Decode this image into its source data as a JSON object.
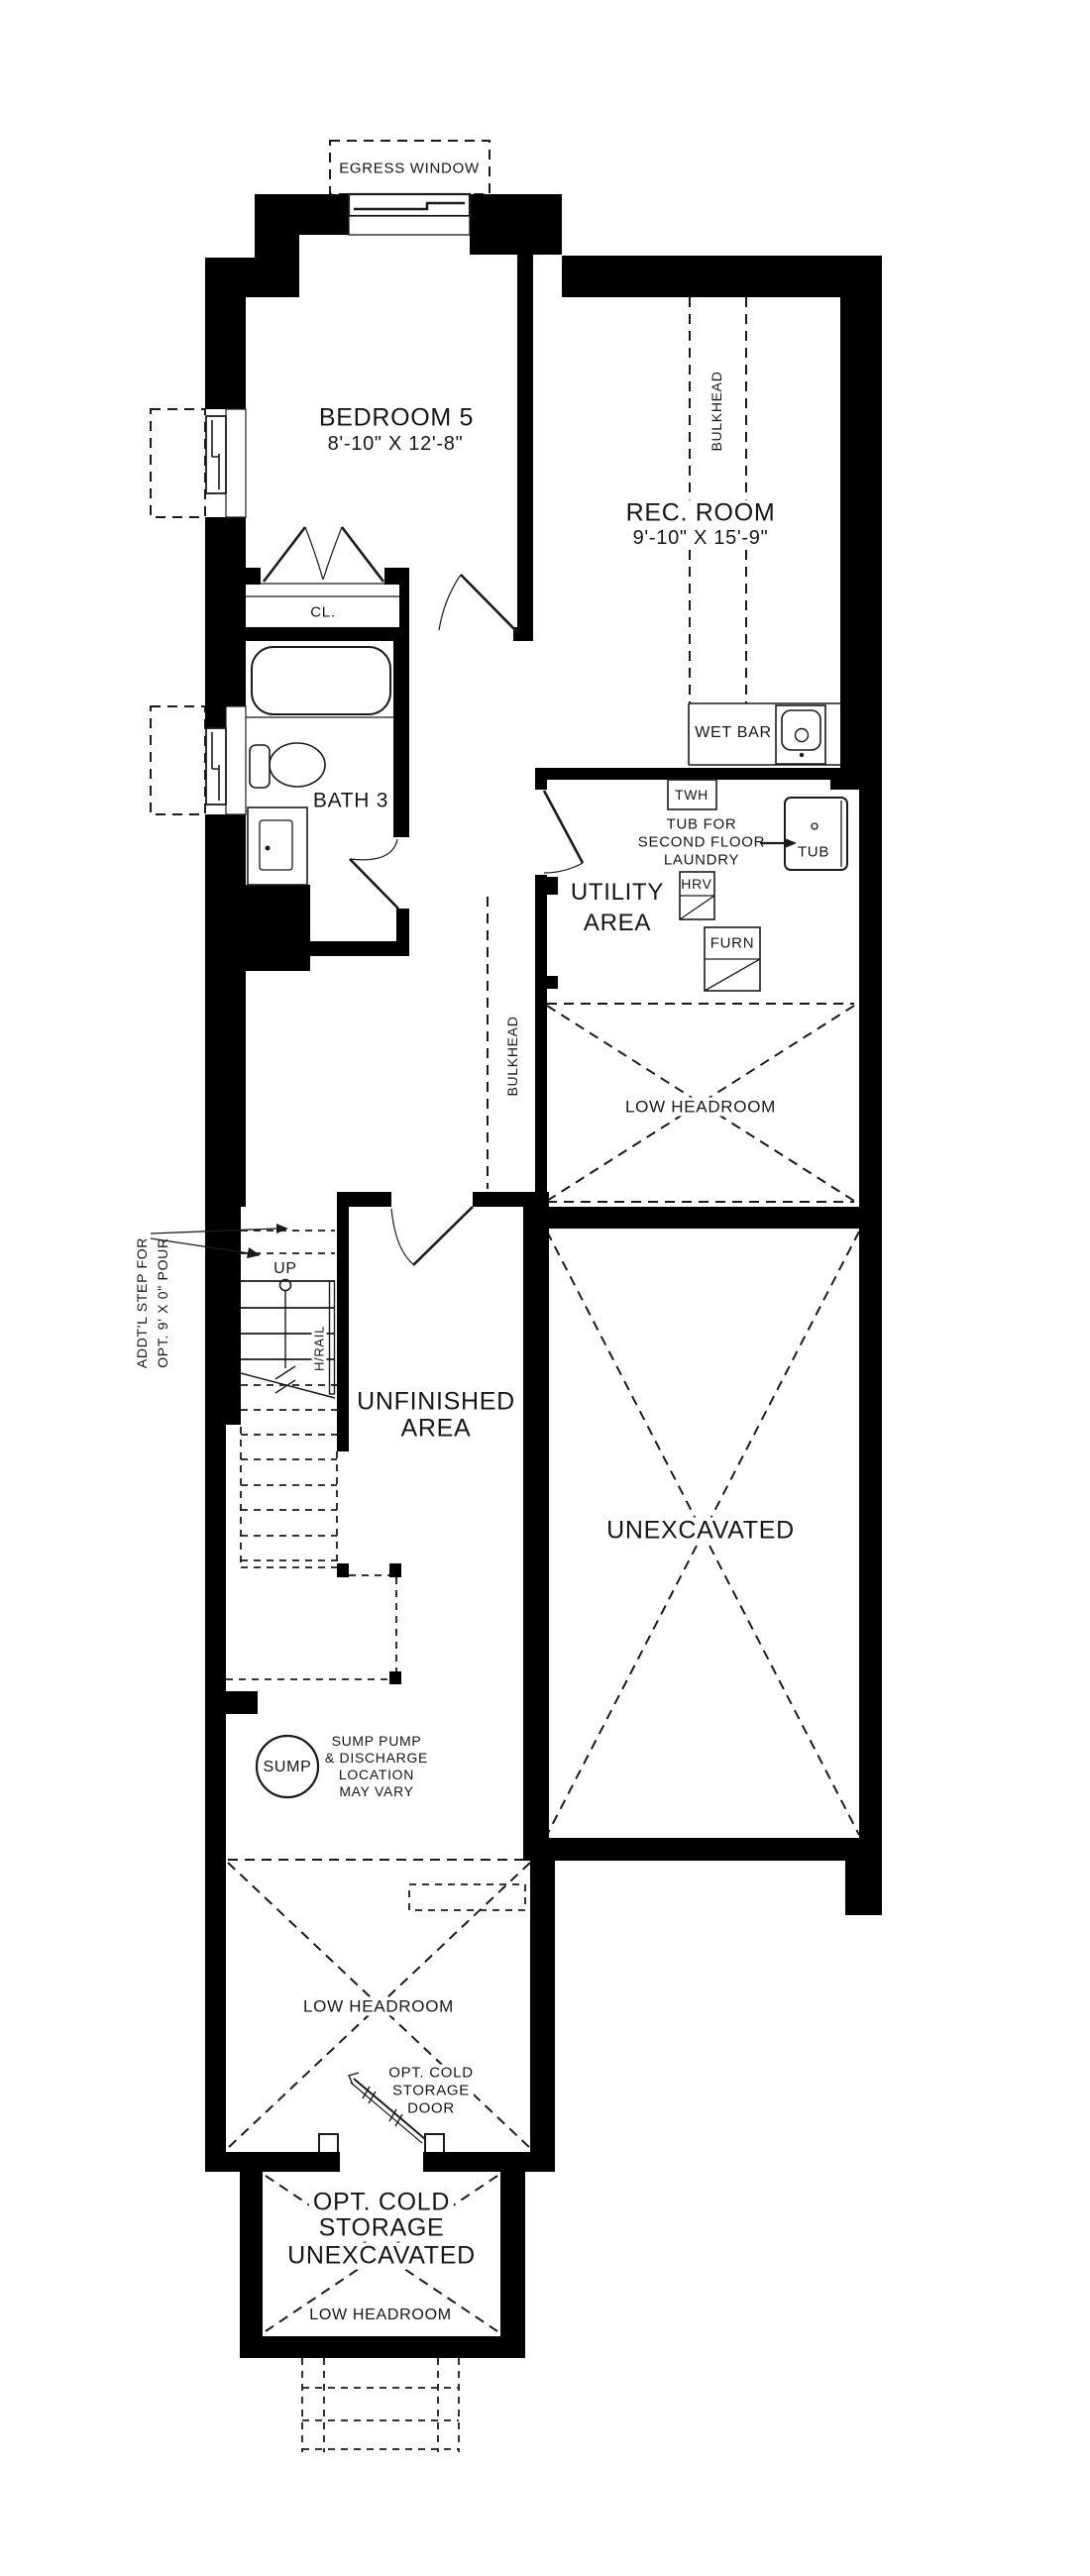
{
  "plan": {
    "egress_window": "EGRESS WINDOW",
    "bedroom": {
      "name": "BEDROOM 5",
      "dims": "8'-10\" X 12'-8\""
    },
    "rec_room": {
      "name": "REC. ROOM",
      "dims": "9'-10\" X 15'-9\""
    },
    "closet": "CL.",
    "bath": "BATH 3",
    "wet_bar": "WET BAR",
    "twh": "TWH",
    "tub": "TUB",
    "tub_note": {
      "l1": "TUB FOR",
      "l2": "SECOND FLOOR",
      "l3": "LAUNDRY"
    },
    "utility": {
      "l1": "UTILITY",
      "l2": "AREA"
    },
    "hrv": "HRV",
    "furn": "FURN",
    "bulkhead": "BULKHEAD",
    "low_headroom": "LOW HEADROOM",
    "up": "UP",
    "hrail": "H/RAIL",
    "addtl_step": {
      "l1": "ADDT'L STEP FOR",
      "l2": "OPT. 9' X 0\" POUR"
    },
    "unfinished": {
      "l1": "UNFINISHED",
      "l2": "AREA"
    },
    "unexcavated": "UNEXCAVATED",
    "sump": "SUMP",
    "sump_note": {
      "l1": "SUMP PUMP",
      "l2": "& DISCHARGE",
      "l3": "LOCATION",
      "l4": "MAY VARY"
    },
    "cold_door": {
      "l1": "OPT. COLD",
      "l2": "STORAGE",
      "l3": "DOOR"
    },
    "cold_storage": {
      "l1": "OPT. COLD",
      "l2": "STORAGE",
      "l3": "UNEXCAVATED",
      "l4": "LOW HEADROOM"
    }
  },
  "colors": {
    "wall": "#000000",
    "line": "#1a1a1a",
    "text": "#161616",
    "background": "#ffffff"
  }
}
